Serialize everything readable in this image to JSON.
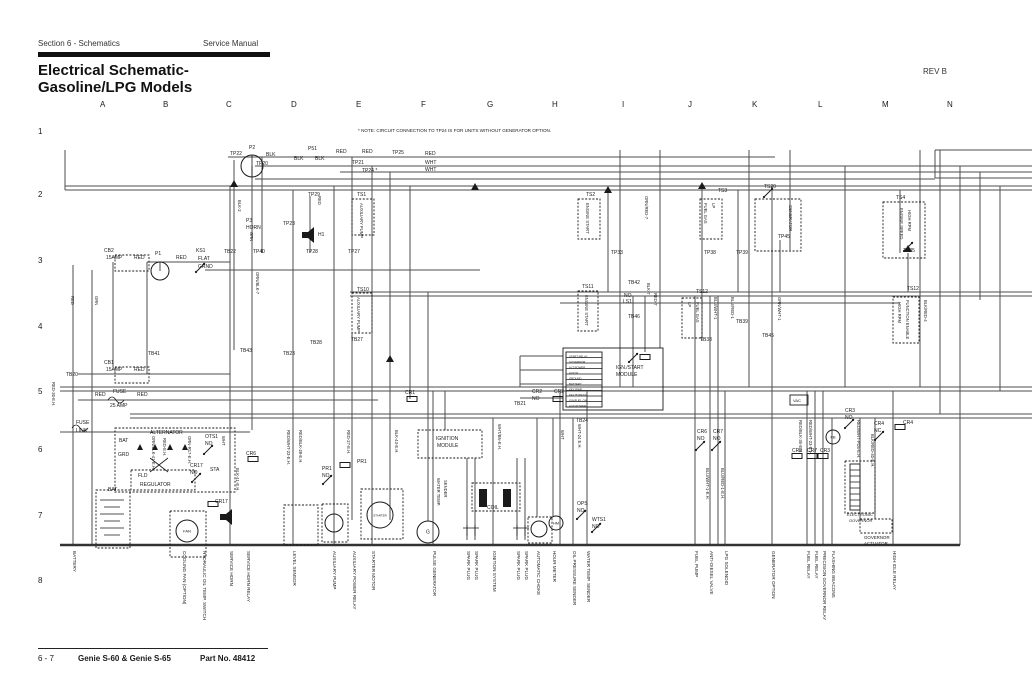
{
  "header": {
    "section": "Section 6 - Schematics",
    "manual": "Service Manual",
    "title_line1": "Electrical Schematic-",
    "title_line2": "Gasoline/LPG Models",
    "rev": "REV B"
  },
  "note": "* NOTE: CIRCUIT CONNECTION TO TP24 IS FOR UNITS WITHOUT GENERATOR OPTION.",
  "footer": {
    "page": "6 - 7",
    "model": "Genie S-60 & Genie S-65",
    "part": "Part No. 48412"
  },
  "grid": {
    "columns": [
      "A",
      "B",
      "C",
      "D",
      "E",
      "F",
      "G",
      "H",
      "I",
      "J",
      "K",
      "L",
      "M",
      "N"
    ],
    "rows": [
      "1",
      "2",
      "3",
      "4",
      "5",
      "6",
      "7",
      "8"
    ]
  },
  "colors": {
    "ink": "#1a1a1a",
    "wire": "#4d4d4d",
    "paper": "#ffffff"
  },
  "schematic": {
    "boxes": [
      [
        352,
        199,
        22,
        36,
        1
      ],
      [
        578,
        199,
        22,
        40,
        1
      ],
      [
        700,
        199,
        22,
        40,
        1
      ],
      [
        755,
        199,
        46,
        52,
        1
      ],
      [
        883,
        202,
        42,
        56,
        1
      ],
      [
        115,
        255,
        34,
        16,
        1
      ],
      [
        115,
        367,
        34,
        16,
        1
      ],
      [
        563,
        348,
        100,
        62,
        0
      ],
      [
        566,
        352,
        36,
        55,
        0
      ],
      [
        418,
        430,
        64,
        28,
        1
      ],
      [
        472,
        483,
        48,
        28,
        1
      ],
      [
        115,
        428,
        120,
        64,
        1
      ],
      [
        131,
        470,
        64,
        20,
        1
      ],
      [
        96,
        490,
        34,
        58,
        1
      ],
      [
        170,
        511,
        36,
        46,
        1
      ],
      [
        361,
        489,
        42,
        50,
        1
      ],
      [
        322,
        504,
        26,
        38,
        1
      ],
      [
        284,
        505,
        34,
        40,
        1
      ],
      [
        528,
        517,
        24,
        26,
        1
      ],
      [
        845,
        461,
        30,
        52,
        1
      ],
      [
        850,
        464,
        10,
        46,
        0
      ],
      [
        860,
        519,
        32,
        14,
        1
      ],
      [
        352,
        293,
        20,
        40,
        1
      ],
      [
        578,
        291,
        20,
        40,
        1
      ],
      [
        682,
        298,
        20,
        40,
        1
      ],
      [
        893,
        297,
        26,
        46,
        1
      ],
      [
        790,
        395,
        18,
        10,
        0
      ]
    ],
    "circles": [
      [
        160,
        271,
        9,
        "",
        3
      ],
      [
        252,
        166,
        11,
        "",
        3
      ],
      [
        187,
        531,
        11,
        "FAN",
        4
      ],
      [
        380,
        515,
        13,
        "STARTER",
        3
      ],
      [
        334,
        523,
        9,
        "",
        3
      ],
      [
        539,
        529,
        8,
        "",
        3
      ],
      [
        556,
        523,
        7,
        "HM",
        4
      ],
      [
        833,
        437,
        7,
        "FB",
        4
      ],
      [
        428,
        532,
        11,
        "G",
        5
      ]
    ],
    "coils": [
      [
        412,
        399
      ],
      [
        558,
        399
      ],
      [
        213,
        504
      ],
      [
        253,
        459
      ],
      [
        345,
        465
      ],
      [
        797,
        456
      ],
      [
        812,
        456
      ],
      [
        823,
        456
      ],
      [
        900,
        427
      ],
      [
        645,
        357
      ]
    ],
    "switches": [
      [
        200,
        268
      ],
      [
        768,
        193
      ],
      [
        633,
        358
      ],
      [
        208,
        450
      ],
      [
        196,
        478
      ],
      [
        327,
        480
      ],
      [
        581,
        515
      ],
      [
        596,
        528
      ],
      [
        700,
        446
      ],
      [
        716,
        446
      ],
      [
        849,
        424
      ],
      [
        879,
        436
      ],
      [
        908,
        247
      ]
    ],
    "labels": [
      [
        "TP22",
        230,
        155
      ],
      [
        "P2",
        249,
        149
      ],
      [
        "BLK",
        266,
        156
      ],
      [
        "BLK",
        294,
        160
      ],
      [
        "BLK",
        315,
        160
      ],
      [
        "P51",
        308,
        150
      ],
      [
        "RED",
        336,
        153
      ],
      [
        "RED",
        362,
        153
      ],
      [
        "TP25",
        392,
        154
      ],
      [
        "RED",
        425,
        155
      ],
      [
        "TP20",
        256,
        165
      ],
      [
        "TP21",
        352,
        164
      ],
      [
        "WHT",
        425,
        164
      ],
      [
        "TP24 *",
        362,
        172
      ],
      [
        "WHT",
        425,
        171
      ],
      [
        "TS1",
        357,
        196
      ],
      [
        "TS2",
        586,
        196
      ],
      [
        "TS3",
        718,
        192
      ],
      [
        "TS20",
        764,
        188
      ],
      [
        "TS4",
        896,
        199
      ],
      [
        "TP29",
        308,
        196
      ],
      [
        "P3",
        246,
        222
      ],
      [
        "HORN",
        246,
        229
      ],
      [
        "H1",
        318,
        236
      ],
      [
        "TP23",
        283,
        225
      ],
      [
        "TB22",
        224,
        253
      ],
      [
        "TP40",
        253,
        253
      ],
      [
        "TP28",
        306,
        253
      ],
      [
        "TP27",
        348,
        253
      ],
      [
        "TP33",
        611,
        254
      ],
      [
        "TP38",
        704,
        254
      ],
      [
        "TP39",
        736,
        254
      ],
      [
        "TP45",
        778,
        238
      ],
      [
        "TP35",
        903,
        252
      ],
      [
        "CB2",
        104,
        252
      ],
      [
        "15AMP",
        106,
        259
      ],
      [
        "RED",
        134,
        259
      ],
      [
        "P1",
        155,
        255
      ],
      [
        "RED",
        176,
        259
      ],
      [
        "KS1",
        196,
        252
      ],
      [
        "FLAT",
        198,
        260
      ],
      [
        "GRND",
        198,
        268
      ],
      [
        "TB41",
        148,
        355
      ],
      [
        "TB43",
        240,
        352
      ],
      [
        "TB23",
        283,
        355
      ],
      [
        "TB28",
        310,
        344
      ],
      [
        "TB27",
        351,
        341
      ],
      [
        "TS10",
        357,
        291
      ],
      [
        "TS11",
        582,
        288
      ],
      [
        "TS12",
        696,
        293
      ],
      [
        "TS12",
        907,
        290
      ],
      [
        "TB42",
        628,
        284
      ],
      [
        "NO",
        624,
        297
      ],
      [
        "LS1",
        623,
        303
      ],
      [
        "TB46",
        628,
        318
      ],
      [
        "TB39",
        736,
        323
      ],
      [
        "TB38",
        700,
        341
      ],
      [
        "TB45",
        762,
        337
      ],
      [
        "TB20",
        66,
        376
      ],
      [
        "CB1",
        104,
        364
      ],
      [
        "15AMP",
        106,
        371
      ],
      [
        "RED",
        134,
        371
      ],
      [
        "RED",
        95,
        396
      ],
      [
        "FUSE",
        113,
        393
      ],
      [
        "25 AMP",
        110,
        407
      ],
      [
        "RED",
        137,
        396
      ],
      [
        "CR1",
        405,
        394
      ],
      [
        "CR2",
        532,
        393
      ],
      [
        "NO",
        532,
        400
      ],
      [
        "CR2",
        554,
        393
      ],
      [
        "TB21",
        514,
        405
      ],
      [
        "TB24",
        576,
        422
      ],
      [
        "IGN./START",
        616,
        369
      ],
      [
        "MODULE",
        616,
        376
      ],
      [
        "START RELAY",
        569,
        357.5,
        0,
        2.8
      ],
      [
        "GOVERNOR",
        569,
        363,
        0,
        2.8
      ],
      [
        "ALT POWER",
        569,
        368.5,
        0,
        2.8
      ],
      [
        "AUX IN",
        569,
        374,
        0,
        2.8
      ],
      [
        "GROUND",
        569,
        379.5,
        0,
        2.8
      ],
      [
        "BATTERY",
        569,
        385,
        0,
        2.8
      ],
      [
        "KEY PWR",
        569,
        390.5,
        0,
        2.8
      ],
      [
        "KEY BYPASS",
        569,
        396,
        0,
        2.8
      ],
      [
        "IGN/FUEL ON",
        569,
        401.5,
        0,
        2.8
      ],
      [
        "AUX POWER",
        569,
        407,
        0,
        2.8
      ],
      [
        "FUSE",
        76,
        424
      ],
      [
        "LINK",
        76,
        432
      ],
      [
        "ALTERNATOR",
        150,
        434
      ],
      [
        "BAT",
        119,
        442
      ],
      [
        "GRD",
        118,
        456
      ],
      [
        "STA",
        210,
        471
      ],
      [
        "FLD",
        138,
        477
      ],
      [
        "REGULATOR",
        140,
        486
      ],
      [
        "OTS1",
        205,
        438
      ],
      [
        "NO",
        205,
        445
      ],
      [
        "CR17",
        190,
        467
      ],
      [
        "NO",
        190,
        474
      ],
      [
        "CR6",
        246,
        455
      ],
      [
        "PR1",
        322,
        470
      ],
      [
        "NO",
        322,
        477
      ],
      [
        "PR1",
        357,
        463
      ],
      [
        "IGNITION",
        436,
        440
      ],
      [
        "MODULE",
        437,
        447
      ],
      [
        "CR6",
        697,
        433
      ],
      [
        "NO",
        697,
        440
      ],
      [
        "CR7",
        713,
        433
      ],
      [
        "NO",
        713,
        440
      ],
      [
        "CR3",
        845,
        412
      ],
      [
        "NO",
        845,
        419
      ],
      [
        "CR4",
        874,
        425
      ],
      [
        "NC",
        874,
        432
      ],
      [
        "CR4",
        903,
        424
      ],
      [
        "CR8",
        792,
        452
      ],
      [
        "CR7",
        807,
        452
      ],
      [
        "CR3",
        820,
        452
      ],
      [
        "VAC",
        793,
        402,
        0,
        4
      ],
      [
        "BAT",
        108,
        491
      ],
      [
        "CR17",
        215,
        503
      ],
      [
        "COIL",
        487,
        509
      ],
      [
        "OPS",
        577,
        505
      ],
      [
        "NO",
        577,
        512
      ],
      [
        "WTS1",
        592,
        521
      ],
      [
        "NO",
        592,
        528
      ],
      [
        "ELECTRONIC",
        847,
        516,
        0,
        4
      ],
      [
        "GOVERNOR",
        849,
        522,
        0,
        4
      ],
      [
        "GOVERNOR",
        864,
        539,
        0,
        4.4
      ],
      [
        "ACTUATOR",
        864,
        545,
        0,
        4.4
      ],
      [
        "BLK-2",
        238,
        200,
        90,
        4.2
      ],
      [
        "GRN",
        250,
        232,
        90,
        4.2
      ],
      [
        "RED",
        318,
        196,
        90,
        4.2
      ],
      [
        "ORN/BLK-7",
        256,
        272,
        90,
        4.2
      ],
      [
        "RED",
        71,
        296,
        90,
        4.2
      ],
      [
        "GRN",
        95,
        296,
        90,
        4.2
      ],
      [
        "RED-30-E.H.",
        52,
        382,
        90,
        4.2
      ],
      [
        "ORN/BLK-41-E.H.",
        152,
        436,
        90,
        4.2
      ],
      [
        "RED-E.H.",
        163,
        438,
        90,
        4.2
      ],
      [
        "ORN-R17-E.H.",
        188,
        436,
        90,
        4.2
      ],
      [
        "WHT",
        222,
        436,
        90,
        4.2
      ],
      [
        "BLK-41-E.H.",
        236,
        468,
        90,
        4.2
      ],
      [
        "RED/WHT-23-E.H.",
        287,
        430,
        90,
        4.2
      ],
      [
        "RED/BLK-28-E.H.",
        299,
        430,
        90,
        4.2
      ],
      [
        "RED-27-E.H.",
        347,
        430,
        90,
        4.2
      ],
      [
        "BLK-43-E.H.",
        395,
        430,
        90,
        4.2
      ],
      [
        "WHT/BN-E.H.",
        498,
        424,
        90,
        4.2
      ],
      [
        "WHT",
        561,
        430,
        90,
        4.2
      ],
      [
        "WHT-24 E.H.",
        578,
        424,
        90,
        4.2
      ],
      [
        "BLK-7",
        647,
        283,
        90,
        4.2
      ],
      [
        "RED-7",
        654,
        293,
        90,
        4.2
      ],
      [
        "BLU/WHT-1",
        714,
        297,
        90,
        4.2
      ],
      [
        "BLU/RED-1",
        731,
        297,
        90,
        4.2
      ],
      [
        "GRN/WHT-1",
        778,
        297,
        90,
        4.2
      ],
      [
        "BLU/WHT-1-E.H.",
        706,
        468,
        90,
        4.2
      ],
      [
        "BLU/RED-1-E.H.",
        721,
        468,
        90,
        4.2
      ],
      [
        "RED/WHT-23-E.H.",
        809,
        420,
        90,
        4.2
      ],
      [
        "RED/BLK-35-E.H.",
        799,
        420,
        90,
        4.2
      ],
      [
        "RED/WHT-PD5-E.H.",
        857,
        420,
        90,
        4.2
      ],
      [
        "BLK/RED-40-E.H.",
        871,
        434,
        90,
        4.2
      ],
      [
        "BLK/RED-4",
        924,
        300,
        90,
        4.2
      ],
      [
        "ORN/RED-7",
        645,
        196,
        90,
        4.2
      ],
      [
        "AUXILIARY PUMP",
        360,
        203,
        90,
        4.2
      ],
      [
        "ENGINE START",
        586,
        203,
        90,
        4.2
      ],
      [
        "FUEL GAS",
        704,
        203,
        90,
        4.2
      ],
      [
        "LP",
        712,
        203,
        90,
        4.2
      ],
      [
        "GENERATOR",
        789,
        205,
        90,
        4.2
      ],
      [
        "ENGINE SPEED",
        900,
        208,
        90,
        4.2
      ],
      [
        "HIGH RPM",
        908,
        210,
        90,
        4.2
      ],
      [
        "AUXILIARY PUMP",
        357,
        297,
        90,
        4.2
      ],
      [
        "ENGINE START",
        585,
        295,
        90,
        4.2
      ],
      [
        "LP",
        688,
        302,
        90,
        4.2
      ],
      [
        "FUEL GAS",
        696,
        302,
        90,
        4.2
      ],
      [
        "HIGH RPM",
        898,
        302,
        90,
        4.2
      ],
      [
        "FUNCTION ENABLE",
        906,
        300,
        90,
        4.2
      ],
      [
        "WATER TEMP.",
        437,
        478,
        90,
        4.2
      ],
      [
        "SENDER",
        444,
        480,
        90,
        4.2
      ]
    ],
    "bottom_labels": [
      [
        73,
        "BATTERY"
      ],
      [
        183,
        "COOLING FAN (OPTION)"
      ],
      [
        203,
        "HYDRAULIC OIL TEMP. SWITCH"
      ],
      [
        230,
        "SERVICE HORN"
      ],
      [
        247,
        "SERVICE HORN RELAY"
      ],
      [
        293,
        "LEVEL SENSOR"
      ],
      [
        333,
        "AUXILIARY PUMP"
      ],
      [
        353,
        "AUXILIARY POWER RELAY"
      ],
      [
        372,
        "STARTER MOTOR"
      ],
      [
        433,
        "PULSE GENERATOR"
      ],
      [
        467,
        "SPARK PLUG"
      ],
      [
        475,
        "SPARK PLUG"
      ],
      [
        493,
        "IGNITION SYSTEM"
      ],
      [
        517,
        "SPARK PLUG"
      ],
      [
        525,
        "SPARK PLUG"
      ],
      [
        537,
        "AUTOMATIC CHOKE"
      ],
      [
        553,
        "HOUR METER"
      ],
      [
        573,
        "OIL PRESSURE SENDER"
      ],
      [
        587,
        "WATER TEMP. SENDER"
      ],
      [
        695,
        "FUEL PUMP"
      ],
      [
        710,
        "ANTI-DIESEL VALVE"
      ],
      [
        725,
        "LPG SOLENOID"
      ],
      [
        772,
        "GENERATOR OPTION"
      ],
      [
        807,
        "FUEL RELAY"
      ],
      [
        815,
        "FUEL RELAY"
      ],
      [
        823,
        "PRECISION GOVERNOR RELAY"
      ],
      [
        832,
        "FLASHING BEACONS"
      ],
      [
        893,
        "HIGH IDLE RELAY"
      ]
    ]
  }
}
